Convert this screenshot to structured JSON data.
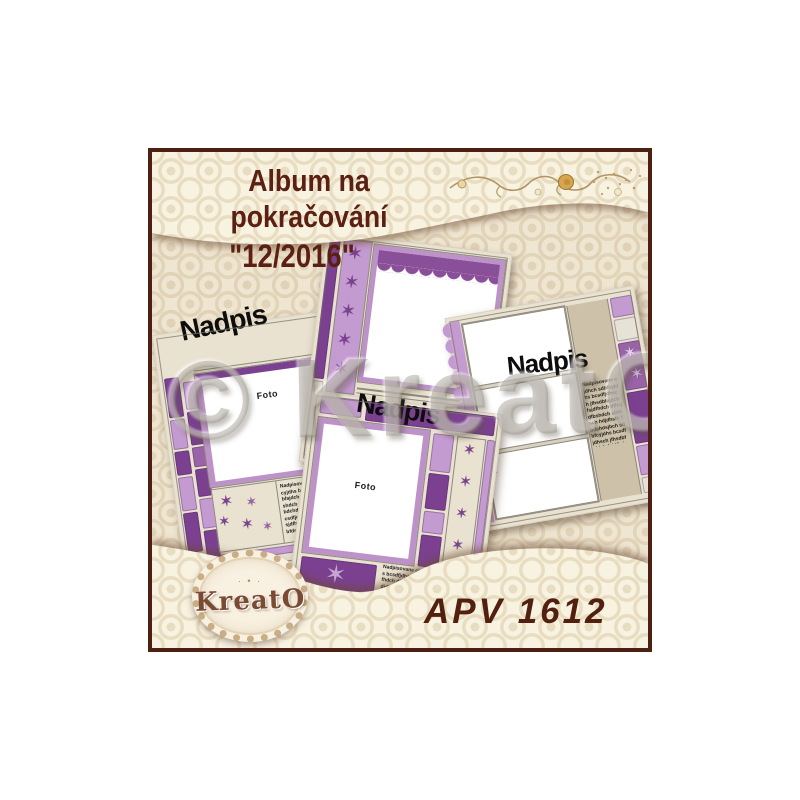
{
  "header": {
    "title_line1": "Album na pokračování",
    "title_line2": "\"12/2016\""
  },
  "watermark": {
    "text": "© KreatO"
  },
  "cards": {
    "card1": {
      "title": "Nadpis",
      "photo_label": "Foto"
    },
    "card2": {
      "title": "Nadpis"
    },
    "card3": {
      "title": "Nadpis"
    },
    "card4": {
      "title": "Nadpis",
      "photo_label": "Foto"
    },
    "microtext": "Nadpisovane cjdhch sdbfcyjdhs bcsdfjdhsch jfhsdbfajdch fsjdfhdch dfhsjdfbshdch sbfdsch hdjdhsfh fbdchdsjbch sdbfcyjdhs bcsdfjdhsch jfhsdbfajdch fsjdfhdch dfhsjdfbshdch sbfdsch hdjdhsfhfbdch"
  },
  "footer": {
    "product_code": "APV 1612",
    "logo_text": "KreatO",
    "logo_ornament": "· • ·"
  },
  "icons": {
    "star": "✶"
  },
  "colors": {
    "frame_border": "#4e2013",
    "title_brown": "#5b2013",
    "purple_dark": "#7b4190",
    "purple_mid": "#9a63a8",
    "purple_light": "#c49bd1",
    "card_cream": "#e9e2d0",
    "taupe": "#cdc1a9",
    "background_base": "#efe6d2",
    "band_base": "#f8f2e1"
  }
}
